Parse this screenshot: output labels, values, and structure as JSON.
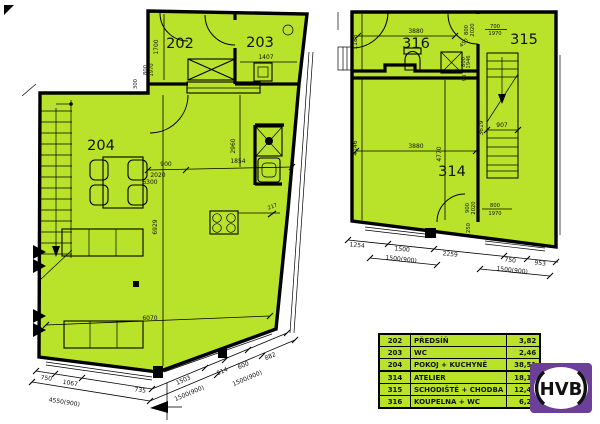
{
  "colors": {
    "plan_fill": "#b8e32a",
    "wall": "#000000",
    "logo_purple": "#6c4098"
  },
  "left_plan": {
    "rooms": {
      "r202": "202",
      "r203": "203",
      "r204": "204"
    },
    "dims": {
      "v1700": "1700",
      "door_w": "800",
      "door_h": "1970",
      "v300": "300",
      "d1407": "1407",
      "d900": "900",
      "d1854": "1854",
      "d2020": "2020",
      "d6300": "6300",
      "v2960": "2960",
      "v6929": "6929",
      "d6070": "6070",
      "d217": "217",
      "b750": "750",
      "b1067": "1067",
      "b735": "735",
      "b1503": "1503",
      "b514": "514",
      "b600": "600",
      "b882": "882",
      "t4550": "4550(900)",
      "t1500a": "1500(900)",
      "t1500b": "1500(900)"
    }
  },
  "right_plan": {
    "rooms": {
      "r314": "314",
      "r315": "315",
      "r316": "316"
    },
    "dims": {
      "t3880": "3880",
      "m3880": "3880",
      "d907": "907",
      "v1188": "1188",
      "v4146": "4146",
      "v3619": "3619",
      "v4770": "4770",
      "door_top_w": "700",
      "door_top_h": "1970",
      "door_top2_w": "800",
      "door_top2_h": "2020",
      "d450": "450",
      "washer_w": "800",
      "washer_h": "1946",
      "d90": "90",
      "door_bot_w": "900",
      "door_bot_h": "2020",
      "door_bot2_w": "800",
      "door_bot2_h": "1970",
      "d250": "250",
      "b1254": "1254",
      "b1500": "1500",
      "b2259": "2259",
      "b750": "750",
      "b953": "953",
      "t1500a": "1500(900)",
      "t1500b": "1500(900)"
    }
  },
  "legend": {
    "rows": [
      {
        "num": "202",
        "name": "PŘEDSÍŇ",
        "area": "3,82"
      },
      {
        "num": "203",
        "name": "WC",
        "area": "2,46"
      },
      {
        "num": "204",
        "name": "POKOJ + KUCHYNĚ",
        "area": "38,51"
      },
      {
        "num": "314",
        "name": "ATELIER",
        "area": "18,15"
      },
      {
        "num": "315",
        "name": "SCHODIŠTĚ + CHODBA",
        "area": "12,48"
      },
      {
        "num": "316",
        "name": "KOUPELNA + WC",
        "area": "6,28"
      }
    ]
  },
  "logo": {
    "text": "HVB"
  }
}
